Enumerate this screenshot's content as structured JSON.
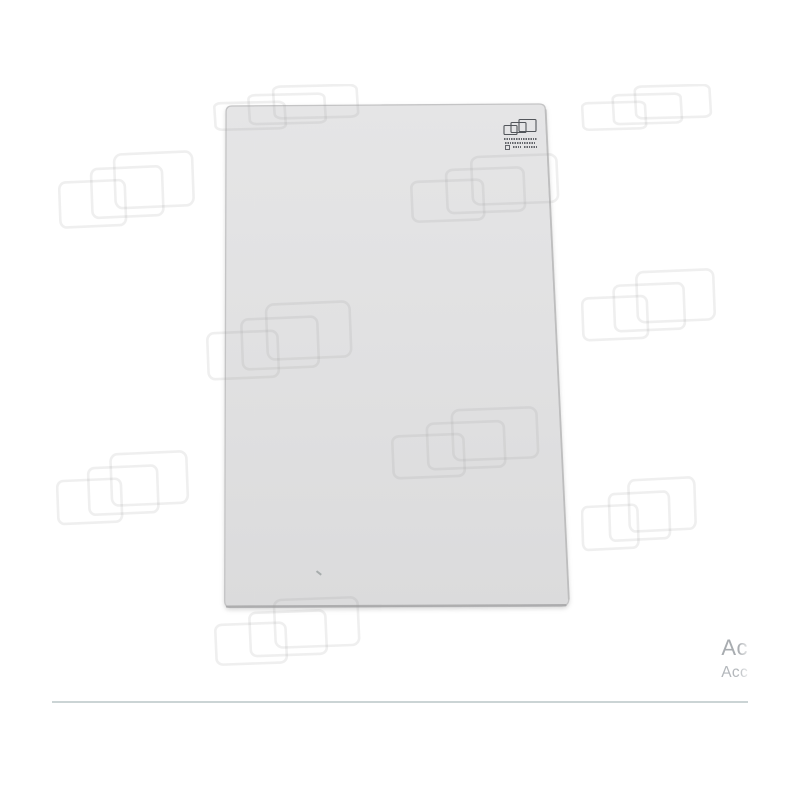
{
  "page": {
    "background_color": "#ffffff"
  },
  "product_photo": {
    "subject": "flat glass panel",
    "glass_fill_top": "#e5e5e6",
    "glass_fill_mid": "#e1e1e2",
    "glass_fill_bottom": "#dbdbdc",
    "edge_color": "#c4c4c5",
    "bottom_edge_color": "#a6a6a7",
    "right_edge_color": "#bcbcbd",
    "stamp": {
      "icon": "overlapping-panes-logo-icon",
      "ink_color": "#3f4348",
      "legible": false
    },
    "scratch_mark_color": "#9aa0a0"
  },
  "watermark": {
    "icon": "overlapping-rectangles-logo",
    "stroke_color": "#9b9b9b",
    "stroke_opacity": 0.16,
    "group_count": 10
  },
  "footer": {
    "truncated_text_line1": "Ac",
    "truncated_text_line2": "Acc",
    "divider_color": "#cbd4d5"
  }
}
